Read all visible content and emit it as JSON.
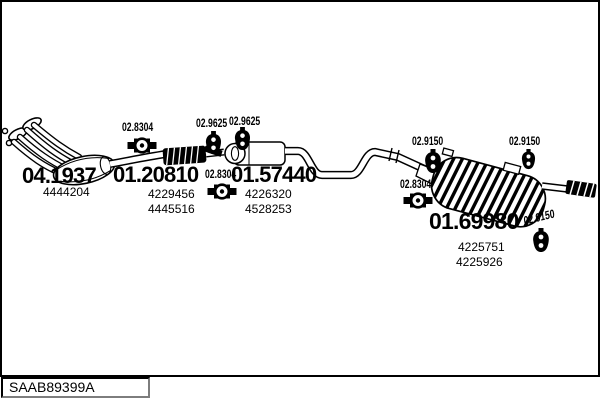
{
  "footer": {
    "code": "SAAB89399A"
  },
  "colors": {
    "ink": "#000000",
    "paper": "#ffffff"
  },
  "assemblies": [
    {
      "name": "front-pipe",
      "code": "04.1937",
      "part_numbers": [
        "4444204"
      ]
    },
    {
      "name": "center-pipe",
      "code": "01.20810",
      "part_numbers": [
        "4229456",
        "4445516"
      ]
    },
    {
      "name": "middle-silencer",
      "code": "01.57440",
      "part_numbers": [
        "4226320",
        "4528253"
      ]
    },
    {
      "name": "rear-silencer",
      "code": "01.69980",
      "part_numbers": [
        "4225751",
        "4225926"
      ]
    }
  ],
  "fittings": [
    {
      "name": "clamp-front",
      "code": "02.8304",
      "type": "clamp"
    },
    {
      "name": "hanger-mid-1",
      "code": "02.9625",
      "type": "hanger"
    },
    {
      "name": "hanger-mid-2",
      "code": "02.9625",
      "type": "hanger"
    },
    {
      "name": "clamp-mid",
      "code": "02.8304",
      "type": "clamp"
    },
    {
      "name": "hanger-rear-left",
      "code": "02.9150",
      "type": "hanger"
    },
    {
      "name": "clamp-rear",
      "code": "02.8304",
      "type": "clamp"
    },
    {
      "name": "hanger-rear-right",
      "code": "02.9150",
      "type": "hanger"
    },
    {
      "name": "hanger-tailpipe",
      "code": "02.9150",
      "type": "hanger"
    }
  ]
}
